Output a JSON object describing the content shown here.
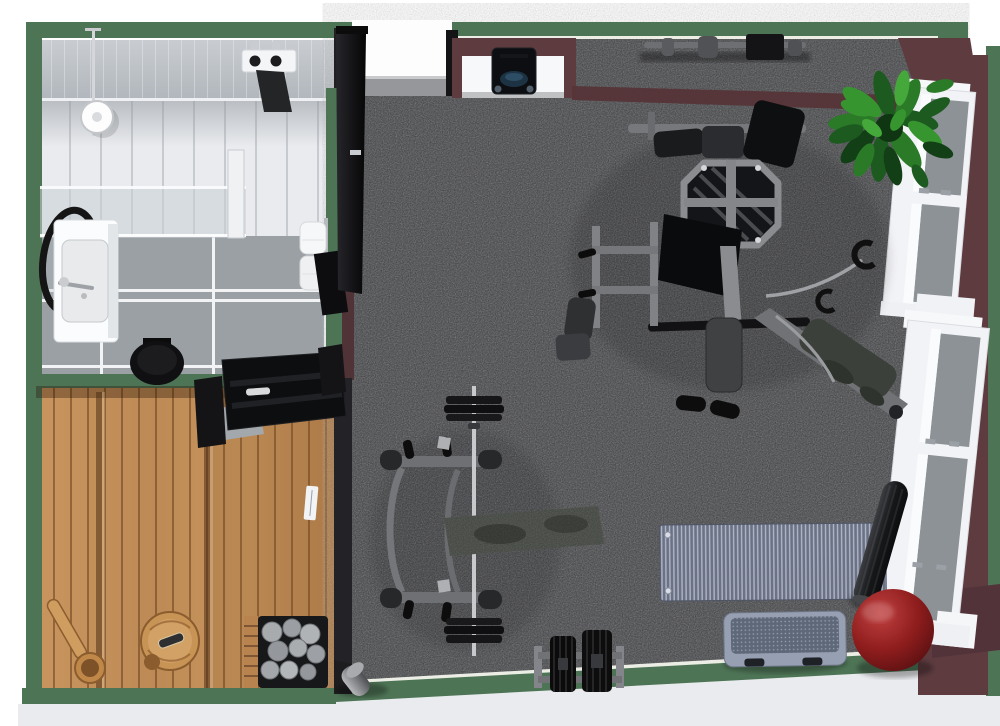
{
  "scene": {
    "view": "3d-floorplan-top-down",
    "rooms": {
      "bathroom": {
        "label": "Bathroom",
        "items": [
          "shower head",
          "glass partition",
          "round mirror",
          "washbasin",
          "faucet",
          "toilet",
          "towel hooks",
          "hanging towel",
          "rolled towels"
        ]
      },
      "sauna": {
        "label": "Sauna",
        "items": [
          "tiered wood benches",
          "sauna heater with stones",
          "wooden bucket",
          "wooden ladle",
          "open black door"
        ]
      },
      "gym": {
        "label": "Gym",
        "items": [
          "entry door",
          "wall table",
          "speaker",
          "wall rack with bar",
          "multi-gym station",
          "barbell on floor rack",
          "weight bench",
          "dumbbell rack",
          "yoga mat",
          "rolled exercise mat",
          "red exercise ball",
          "aerobic step",
          "foam roller",
          "potted plant"
        ]
      }
    },
    "windows": {
      "count": 2,
      "wall": "right"
    },
    "palette": {
      "outer_wall": "#4e7456",
      "interior_wall": "#5d3b3f",
      "carpet": "#3c3d40",
      "wood": "#c6925f",
      "tile_floor": "#9aa0a4",
      "ball": "#8f1d1d",
      "mat": "#6b7285",
      "window_frame": "#f2f3f6",
      "slab": "#e9ebee"
    }
  }
}
